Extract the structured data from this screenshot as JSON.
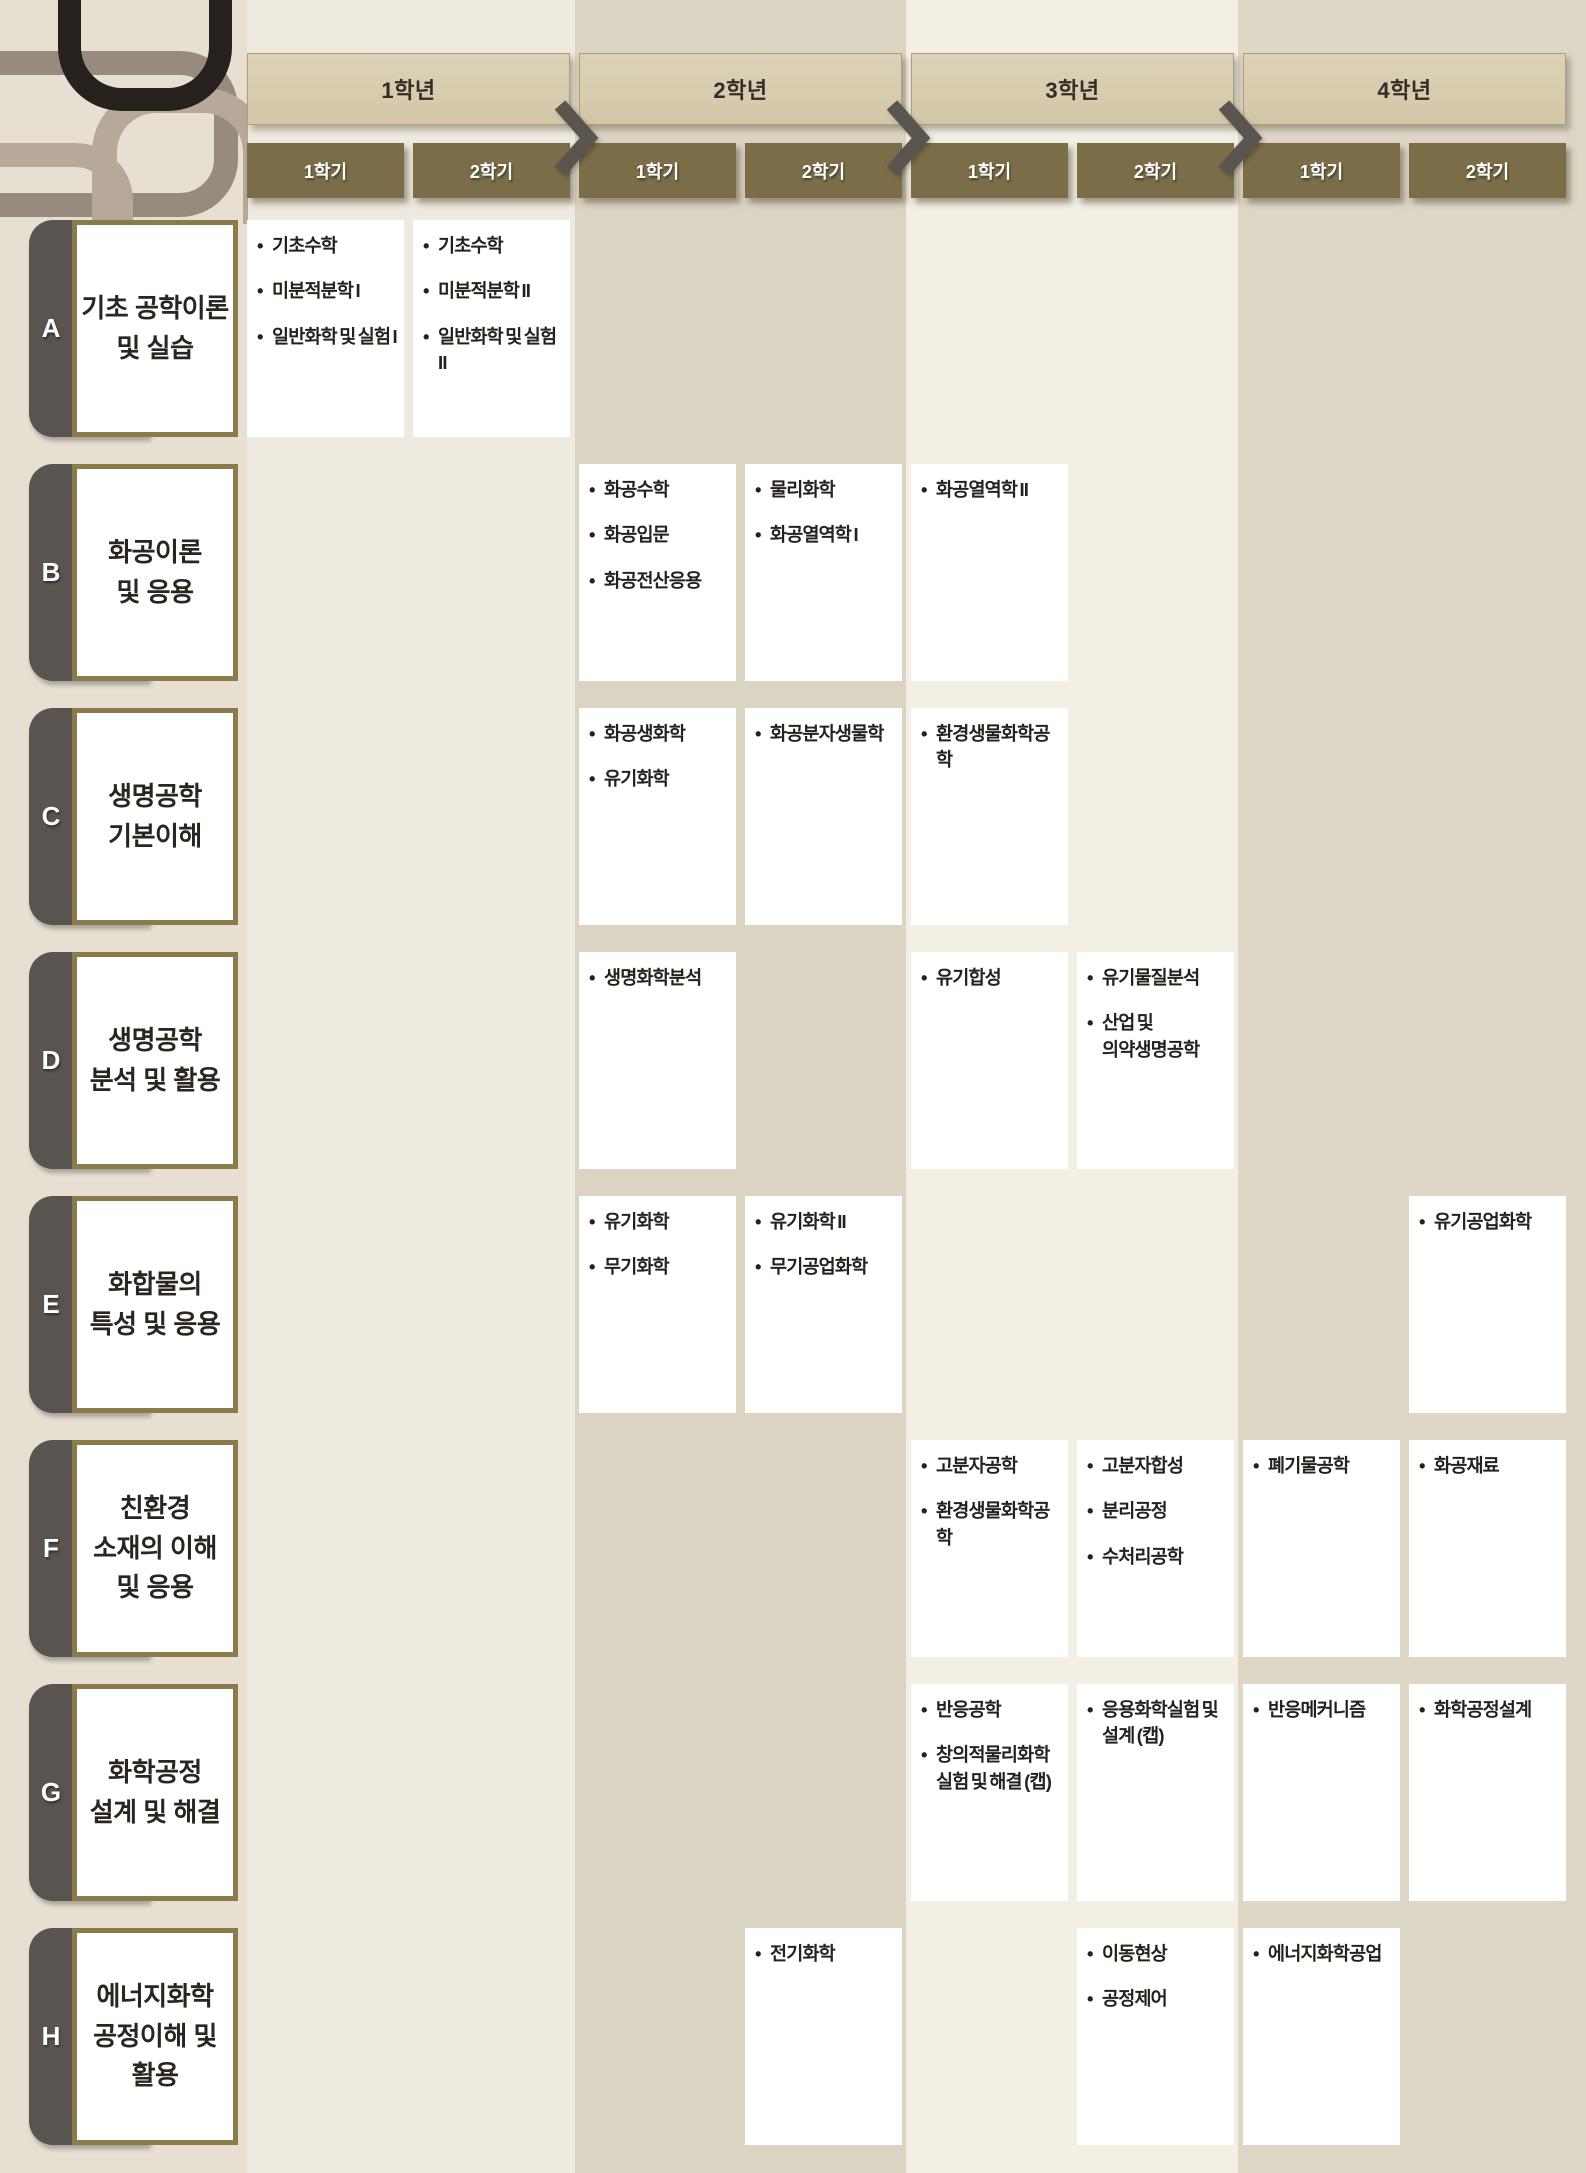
{
  "header": {
    "years": [
      {
        "label": "1학년",
        "semesters": [
          "1학기",
          "2학기"
        ]
      },
      {
        "label": "2학년",
        "semesters": [
          "1학기",
          "2학기"
        ]
      },
      {
        "label": "3학년",
        "semesters": [
          "1학기",
          "2학기"
        ]
      },
      {
        "label": "4학년",
        "semesters": [
          "1학기",
          "2학기"
        ]
      }
    ]
  },
  "categories": [
    {
      "id": "A",
      "lines": [
        "기초 공학이론",
        "및 실습"
      ]
    },
    {
      "id": "B",
      "lines": [
        "화공이론",
        "및 응용"
      ]
    },
    {
      "id": "C",
      "lines": [
        "생명공학",
        "기본이해"
      ]
    },
    {
      "id": "D",
      "lines": [
        "생명공학",
        "분석 및 활용"
      ]
    },
    {
      "id": "E",
      "lines": [
        "화합물의",
        "특성 및 응용"
      ]
    },
    {
      "id": "F",
      "lines": [
        "친환경",
        "소재의 이해",
        "및 응용"
      ]
    },
    {
      "id": "G",
      "lines": [
        "화학공정",
        "설계 및 해결"
      ]
    },
    {
      "id": "H",
      "lines": [
        "에너지화학",
        "공정이해 및",
        "활용"
      ]
    }
  ],
  "cells": [
    {
      "row": "A",
      "year": 1,
      "semester": 1,
      "courses": [
        "기초수학",
        "미분적분학 I",
        "일반화학 및 실험 I"
      ]
    },
    {
      "row": "A",
      "year": 1,
      "semester": 2,
      "courses": [
        "기초수학",
        "미분적분학 II",
        "일반화학 및 실험 II"
      ]
    },
    {
      "row": "B",
      "year": 2,
      "semester": 1,
      "courses": [
        "화공수학",
        "화공입문",
        "화공전산응용"
      ]
    },
    {
      "row": "B",
      "year": 2,
      "semester": 2,
      "courses": [
        "물리화학",
        "화공열역학 I"
      ]
    },
    {
      "row": "B",
      "year": 3,
      "semester": 1,
      "courses": [
        "화공열역학 II"
      ]
    },
    {
      "row": "C",
      "year": 2,
      "semester": 1,
      "courses": [
        "화공생화학",
        "유기화학"
      ]
    },
    {
      "row": "C",
      "year": 2,
      "semester": 2,
      "courses": [
        "화공분자생물학"
      ]
    },
    {
      "row": "C",
      "year": 3,
      "semester": 1,
      "courses": [
        "환경생물화학공학"
      ]
    },
    {
      "row": "D",
      "year": 2,
      "semester": 1,
      "courses": [
        "생명화학분석"
      ]
    },
    {
      "row": "D",
      "year": 3,
      "semester": 1,
      "courses": [
        "유기합성"
      ]
    },
    {
      "row": "D",
      "year": 3,
      "semester": 2,
      "courses": [
        "유기물질분석",
        "산업 및 의약생명공학"
      ]
    },
    {
      "row": "E",
      "year": 2,
      "semester": 1,
      "courses": [
        "유기화학",
        "무기화학"
      ]
    },
    {
      "row": "E",
      "year": 2,
      "semester": 2,
      "courses": [
        "유기화학 II",
        "무기공업화학"
      ]
    },
    {
      "row": "E",
      "year": 4,
      "semester": 2,
      "courses": [
        "유기공업화학"
      ]
    },
    {
      "row": "F",
      "year": 3,
      "semester": 1,
      "courses": [
        "고분자공학",
        "환경생물화학공학"
      ]
    },
    {
      "row": "F",
      "year": 3,
      "semester": 2,
      "courses": [
        "고분자합성",
        "분리공정",
        "수처리공학"
      ]
    },
    {
      "row": "F",
      "year": 4,
      "semester": 1,
      "courses": [
        "폐기물공학"
      ]
    },
    {
      "row": "F",
      "year": 4,
      "semester": 2,
      "courses": [
        "화공재료"
      ]
    },
    {
      "row": "G",
      "year": 3,
      "semester": 1,
      "courses": [
        "반응공학",
        "창의적물리화학실험 및 해결 (캡)"
      ]
    },
    {
      "row": "G",
      "year": 3,
      "semester": 2,
      "courses": [
        "응용화학실험 및 설계 (캡)"
      ]
    },
    {
      "row": "G",
      "year": 4,
      "semester": 1,
      "courses": [
        "반응메커니즘"
      ]
    },
    {
      "row": "G",
      "year": 4,
      "semester": 2,
      "courses": [
        "화학공정설계"
      ]
    },
    {
      "row": "H",
      "year": 2,
      "semester": 2,
      "courses": [
        "전기화학"
      ]
    },
    {
      "row": "H",
      "year": 3,
      "semester": 2,
      "courses": [
        "이동현상",
        "공정제어"
      ]
    },
    {
      "row": "H",
      "year": 4,
      "semester": 1,
      "courses": [
        "에너지화학공업"
      ]
    }
  ],
  "colors": {
    "page_background": "#e7e0d2",
    "stripe_category": "#e7e0d2",
    "stripe_year1": "#eeeadf",
    "stripe_year2": "#dcd4c2",
    "stripe_year3": "#f3efe5",
    "stripe_year4": "#ded7c6",
    "year_header_bg": "#d7ccae",
    "semester_header_bg": "#7b6d48",
    "semester_header_text": "#ffffff",
    "chevron": "#5b5550",
    "category_tab": "#5a5450",
    "category_border": "#8b7b4a",
    "cell_bg": "#ffffff",
    "text": "#26211c"
  }
}
